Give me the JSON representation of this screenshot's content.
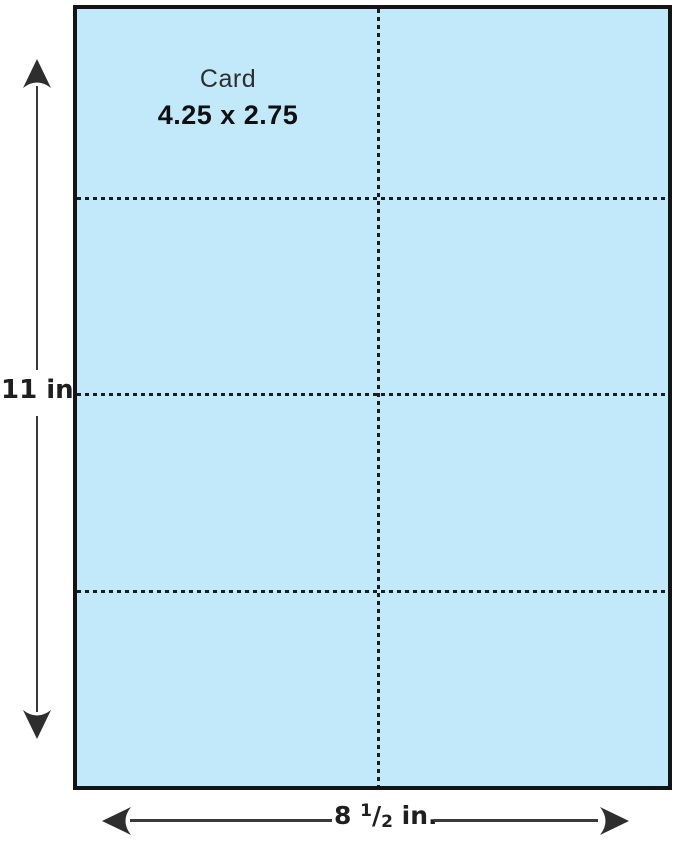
{
  "colors": {
    "paper_fill": "#c2e9fa",
    "paper_border": "#141414",
    "perforation": "#1c1c1c",
    "dimension_line": "#3a3a3a",
    "text": "#1f1f1f",
    "background": "#ffffff"
  },
  "sheet": {
    "card_label": "Card",
    "card_size_label": "4.25 x 2.75",
    "columns": 2,
    "rows": 4
  },
  "dimensions": {
    "height_label": "11 in",
    "width_whole": "8",
    "width_numerator": "1",
    "width_slash": "/",
    "width_denominator": "2",
    "width_unit": " in."
  }
}
